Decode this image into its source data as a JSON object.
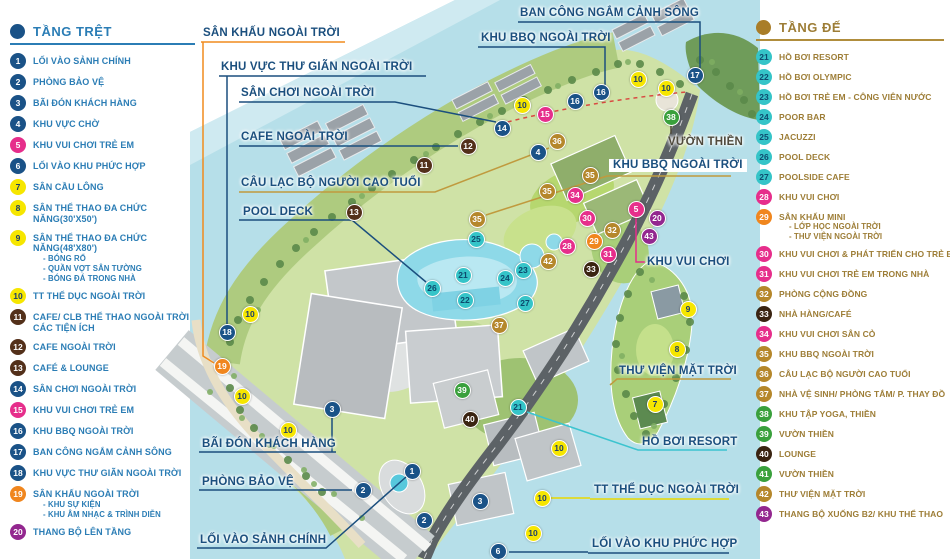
{
  "legend_left": {
    "title": "TẦNG TRỆT",
    "accent": "#2b7db5",
    "dot_color": "#1a5287",
    "items": [
      {
        "num": "1",
        "label": "LỐI VÀO SẢNH CHÍNH",
        "color": "#1a5287"
      },
      {
        "num": "2",
        "label": "PHÒNG BẢO VỆ",
        "color": "#1a5287"
      },
      {
        "num": "3",
        "label": "BÃI ĐÓN KHÁCH HÀNG",
        "color": "#1a5287"
      },
      {
        "num": "4",
        "label": "KHU VỰC CHỜ",
        "color": "#1a5287"
      },
      {
        "num": "5",
        "label": "KHU VUI CHƠI TRẺ EM",
        "color": "#e62e8b"
      },
      {
        "num": "6",
        "label": "LỐI VÀO KHU PHỨC HỢP",
        "color": "#1a5287"
      },
      {
        "num": "7",
        "label": "SÂN CẦU LÔNG",
        "color": "#f6e600",
        "num_color": "#1c3e6b"
      },
      {
        "num": "8",
        "label": "SÂN THỂ THAO ĐA CHỨC NĂNG(30'X50')",
        "color": "#f6e600",
        "num_color": "#1c3e6b"
      },
      {
        "num": "9",
        "label": "SÂN THỂ THAO ĐA CHỨC NĂNG(48'X80')",
        "color": "#f6e600",
        "num_color": "#1c3e6b",
        "sub": [
          "- BÓNG RỔ",
          "- QUẦN VỢT SÂN TƯỜNG",
          "- BÓNG ĐÁ TRONG NHÀ"
        ]
      },
      {
        "num": "10",
        "label": "TT THỂ DỤC NGOÀI TRỜI",
        "color": "#f6e600",
        "num_color": "#1c3e6b"
      },
      {
        "num": "11",
        "label": "CAFE/ CLB THỂ THAO NGOÀI TRỜI CÁC TIỆN ÍCH",
        "color": "#53301a"
      },
      {
        "num": "12",
        "label": "CAFE NGOÀI TRỜI",
        "color": "#53301a"
      },
      {
        "num": "13",
        "label": "CAFÉ & LOUNGE",
        "color": "#53301a"
      },
      {
        "num": "14",
        "label": "SÂN CHƠI NGOÀI TRỜI",
        "color": "#1a5287"
      },
      {
        "num": "15",
        "label": "KHU VUI CHƠI TRẺ EM",
        "color": "#e62e8b"
      },
      {
        "num": "16",
        "label": "KHU BBQ NGOÀI TRỜI",
        "color": "#1a5287"
      },
      {
        "num": "17",
        "label": "BAN CÔNG NGẮM CẢNH SÔNG",
        "color": "#1a5287"
      },
      {
        "num": "18",
        "label": "KHU VỰC THƯ GIÃN NGOÀI TRỜI",
        "color": "#1a5287"
      },
      {
        "num": "19",
        "label": "SÂN KHẤU NGOÀI TRỜI",
        "color": "#f0861e",
        "sub": [
          "- KHU SỰ KIỆN",
          "- KHU ÂM NHẠC & TRÌNH DIỄN"
        ]
      },
      {
        "num": "20",
        "label": "THANG BỘ LÊN TẦNG",
        "color": "#93278f"
      }
    ]
  },
  "legend_right": {
    "title": "TẦNG ĐẾ",
    "accent": "#9d7d36",
    "dot_color": "#a97d28",
    "items": [
      {
        "num": "21",
        "label": "HỒ BƠI RESORT",
        "color": "#35c4c8",
        "num_color": "#0d4a6e"
      },
      {
        "num": "22",
        "label": "HỒ BƠI OLYMPIC",
        "color": "#35c4c8",
        "num_color": "#0d4a6e"
      },
      {
        "num": "23",
        "label": "HỒ BƠI TRẺ EM - CÔNG VIÊN NƯỚC",
        "color": "#35c4c8",
        "num_color": "#0d4a6e"
      },
      {
        "num": "24",
        "label": "POOR BAR",
        "color": "#35c4c8",
        "num_color": "#0d4a6e"
      },
      {
        "num": "25",
        "label": "JACUZZI",
        "color": "#35c4c8",
        "num_color": "#0d4a6e"
      },
      {
        "num": "26",
        "label": "POOL DECK",
        "color": "#35c4c8",
        "num_color": "#0d4a6e"
      },
      {
        "num": "27",
        "label": "POOLSIDE CAFE",
        "color": "#35c4c8",
        "num_color": "#0d4a6e"
      },
      {
        "num": "28",
        "label": "KHU VUI CHƠI",
        "color": "#e62e8b"
      },
      {
        "num": "29",
        "label": "SÂN KHẤU MINI",
        "color": "#f0861e",
        "sub": [
          "- LỚP HỌC NGOÀI TRỜI",
          "- THƯ VIỆN NGOÀI TRỜI"
        ]
      },
      {
        "num": "30",
        "label": "KHU VUI CHƠI & PHÁT TRIỂN CHO TRẺ EM",
        "color": "#e62e8b"
      },
      {
        "num": "31",
        "label": "KHU VUI CHƠI TRẺ EM TRONG NHÀ",
        "color": "#e62e8b"
      },
      {
        "num": "32",
        "label": "PHÒNG CỘNG ĐỒNG",
        "color": "#b5872b"
      },
      {
        "num": "33",
        "label": "NHÀ HÀNG/CAFÉ",
        "color": "#3a2311"
      },
      {
        "num": "34",
        "label": "KHU VUI CHƠI SÂN CỎ",
        "color": "#e62e8b"
      },
      {
        "num": "35",
        "label": "KHU BBQ NGOÀI TRỜI",
        "color": "#b5872b"
      },
      {
        "num": "36",
        "label": "CÂU LẠC BỘ NGƯỜI CAO TUỔI",
        "color": "#b5872b"
      },
      {
        "num": "37",
        "label": "NHÀ VỆ SINH/ PHÒNG TẮM/ P. THAY ĐỒ",
        "color": "#b5872b"
      },
      {
        "num": "38",
        "label": "KHU TẬP YOGA, THIỀN",
        "color": "#3aa03c"
      },
      {
        "num": "39",
        "label": "VƯỜN THIỀN",
        "color": "#3aa03c"
      },
      {
        "num": "40",
        "label": "LOUNGE",
        "color": "#3a2311"
      },
      {
        "num": "41",
        "label": "VƯỜN THIỀN",
        "color": "#3aa03c"
      },
      {
        "num": "42",
        "label": "THƯ VIỆN MẶT TRỜI",
        "color": "#b5872b"
      },
      {
        "num": "43",
        "label": "THANG BỘ XUỐNG B2/ KHU THỂ THAO",
        "color": "#93278f"
      }
    ]
  },
  "map": {
    "label_color": "#1b4f7e",
    "labels": [
      {
        "text": "BAN CÔNG NGẮM CẢNH SÔNG",
        "x": 520,
        "y": 7
      },
      {
        "text": "KHU BBQ NGOÀI TRỜI",
        "x": 481,
        "y": 32
      },
      {
        "text": "SÂN KHẤU NGOÀI TRỜI",
        "x": 203,
        "y": 27
      },
      {
        "text": "KHU VỰC THƯ GIÃN NGOÀI TRỜI",
        "x": 221,
        "y": 61
      },
      {
        "text": "SÂN CHƠI NGOÀI TRỜI",
        "x": 241,
        "y": 87
      },
      {
        "text": "CAFE NGOÀI TRỜI",
        "x": 241,
        "y": 131
      },
      {
        "text": "CÂU LẠC BỘ NGƯỜI CAO TUỔI",
        "x": 241,
        "y": 177
      },
      {
        "text": "POOL DECK",
        "x": 243,
        "y": 206
      },
      {
        "text": "VƯỜN THIỀN",
        "x": 668,
        "y": 136,
        "color": "#4f4a3d"
      },
      {
        "text": "KHU BBQ NGOÀI TRỜI",
        "x": 609,
        "y": 159,
        "boxed": true
      },
      {
        "text": "KHU VUI CHƠI",
        "x": 647,
        "y": 256
      },
      {
        "text": "THƯ VIỆN MẶT TRỜI",
        "x": 619,
        "y": 365
      },
      {
        "text": "HỒ BƠI RESORT",
        "x": 642,
        "y": 436
      },
      {
        "text": "TT THỂ DỤC NGOÀI TRỜI",
        "x": 594,
        "y": 484
      },
      {
        "text": "LỐI VÀO KHU PHỨC HỢP",
        "x": 592,
        "y": 538
      },
      {
        "text": "BÃI ĐÓN KHÁCH HÀNG",
        "x": 202,
        "y": 438
      },
      {
        "text": "PHÒNG BẢO VỆ",
        "x": 202,
        "y": 476
      },
      {
        "text": "LỐI VÀO SẢNH CHÍNH",
        "x": 200,
        "y": 534
      }
    ],
    "markers": [
      {
        "num": "10",
        "x": 522,
        "y": 105,
        "color": "#f6e600",
        "num_color": "#1c3e6b"
      },
      {
        "num": "15",
        "x": 545,
        "y": 114,
        "color": "#e62e8b"
      },
      {
        "num": "16",
        "x": 575,
        "y": 101,
        "color": "#1a5287"
      },
      {
        "num": "16",
        "x": 601,
        "y": 92,
        "color": "#1a5287"
      },
      {
        "num": "10",
        "x": 638,
        "y": 79,
        "color": "#f6e600",
        "num_color": "#1c3e6b"
      },
      {
        "num": "10",
        "x": 666,
        "y": 88,
        "color": "#f6e600",
        "num_color": "#1c3e6b"
      },
      {
        "num": "17",
        "x": 695,
        "y": 75,
        "color": "#1a5287"
      },
      {
        "num": "38",
        "x": 671,
        "y": 117,
        "color": "#3aa03c"
      },
      {
        "num": "14",
        "x": 502,
        "y": 128,
        "color": "#1a5287"
      },
      {
        "num": "12",
        "x": 468,
        "y": 146,
        "color": "#53301a"
      },
      {
        "num": "11",
        "x": 424,
        "y": 165,
        "color": "#53301a"
      },
      {
        "num": "36",
        "x": 557,
        "y": 141,
        "color": "#b5872b"
      },
      {
        "num": "4",
        "x": 538,
        "y": 152,
        "color": "#1a5287"
      },
      {
        "num": "13",
        "x": 354,
        "y": 212,
        "color": "#53301a"
      },
      {
        "num": "35",
        "x": 477,
        "y": 219,
        "color": "#b5872b"
      },
      {
        "num": "35",
        "x": 547,
        "y": 191,
        "color": "#b5872b"
      },
      {
        "num": "35",
        "x": 590,
        "y": 175,
        "color": "#b5872b"
      },
      {
        "num": "34",
        "x": 575,
        "y": 195,
        "color": "#e62e8b"
      },
      {
        "num": "25",
        "x": 476,
        "y": 239,
        "color": "#35c4c8",
        "num_color": "#0d4a6e"
      },
      {
        "num": "21",
        "x": 463,
        "y": 275,
        "color": "#35c4c8",
        "num_color": "#0d4a6e"
      },
      {
        "num": "26",
        "x": 432,
        "y": 288,
        "color": "#35c4c8",
        "num_color": "#0d4a6e"
      },
      {
        "num": "22",
        "x": 465,
        "y": 300,
        "color": "#35c4c8",
        "num_color": "#0d4a6e"
      },
      {
        "num": "24",
        "x": 505,
        "y": 278,
        "color": "#35c4c8",
        "num_color": "#0d4a6e"
      },
      {
        "num": "23",
        "x": 523,
        "y": 270,
        "color": "#35c4c8",
        "num_color": "#0d4a6e"
      },
      {
        "num": "27",
        "x": 525,
        "y": 303,
        "color": "#35c4c8",
        "num_color": "#0d4a6e"
      },
      {
        "num": "37",
        "x": 499,
        "y": 325,
        "color": "#b5872b"
      },
      {
        "num": "42",
        "x": 548,
        "y": 261,
        "color": "#b5872b"
      },
      {
        "num": "30",
        "x": 587,
        "y": 218,
        "color": "#e62e8b"
      },
      {
        "num": "28",
        "x": 567,
        "y": 246,
        "color": "#e62e8b"
      },
      {
        "num": "29",
        "x": 594,
        "y": 241,
        "color": "#f0861e"
      },
      {
        "num": "31",
        "x": 608,
        "y": 254,
        "color": "#e62e8b"
      },
      {
        "num": "32",
        "x": 612,
        "y": 230,
        "color": "#b5872b"
      },
      {
        "num": "33",
        "x": 591,
        "y": 269,
        "color": "#3a2311"
      },
      {
        "num": "5",
        "x": 636,
        "y": 209,
        "color": "#e62e8b"
      },
      {
        "num": "20",
        "x": 657,
        "y": 218,
        "color": "#93278f"
      },
      {
        "num": "43",
        "x": 649,
        "y": 236,
        "color": "#93278f"
      },
      {
        "num": "10",
        "x": 250,
        "y": 314,
        "color": "#f6e600",
        "num_color": "#1c3e6b"
      },
      {
        "num": "18",
        "x": 227,
        "y": 332,
        "color": "#1a5287"
      },
      {
        "num": "19",
        "x": 222,
        "y": 366,
        "color": "#f0861e"
      },
      {
        "num": "10",
        "x": 242,
        "y": 396,
        "color": "#f6e600",
        "num_color": "#1c3e6b"
      },
      {
        "num": "10",
        "x": 288,
        "y": 430,
        "color": "#f6e600",
        "num_color": "#1c3e6b"
      },
      {
        "num": "3",
        "x": 332,
        "y": 409,
        "color": "#1a5287"
      },
      {
        "num": "39",
        "x": 462,
        "y": 390,
        "color": "#3aa03c"
      },
      {
        "num": "40",
        "x": 470,
        "y": 419,
        "color": "#3a2311"
      },
      {
        "num": "21",
        "x": 518,
        "y": 407,
        "color": "#35c4c8",
        "num_color": "#0d4a6e"
      },
      {
        "num": "1",
        "x": 412,
        "y": 471,
        "color": "#1a5287"
      },
      {
        "num": "2",
        "x": 363,
        "y": 490,
        "color": "#1a5287"
      },
      {
        "num": "2",
        "x": 424,
        "y": 520,
        "color": "#1a5287"
      },
      {
        "num": "3",
        "x": 480,
        "y": 501,
        "color": "#1a5287"
      },
      {
        "num": "6",
        "x": 498,
        "y": 551,
        "color": "#1a5287"
      },
      {
        "num": "10",
        "x": 559,
        "y": 448,
        "color": "#f6e600",
        "num_color": "#1c3e6b"
      },
      {
        "num": "10",
        "x": 542,
        "y": 498,
        "color": "#f6e600",
        "num_color": "#1c3e6b"
      },
      {
        "num": "10",
        "x": 533,
        "y": 533,
        "color": "#f6e600",
        "num_color": "#1c3e6b"
      },
      {
        "num": "9",
        "x": 688,
        "y": 309,
        "color": "#f6e600",
        "num_color": "#1c3e6b"
      },
      {
        "num": "8",
        "x": 677,
        "y": 349,
        "color": "#f6e600",
        "num_color": "#1c3e6b"
      },
      {
        "num": "7",
        "x": 655,
        "y": 404,
        "color": "#f6e600",
        "num_color": "#1c3e6b"
      }
    ]
  }
}
